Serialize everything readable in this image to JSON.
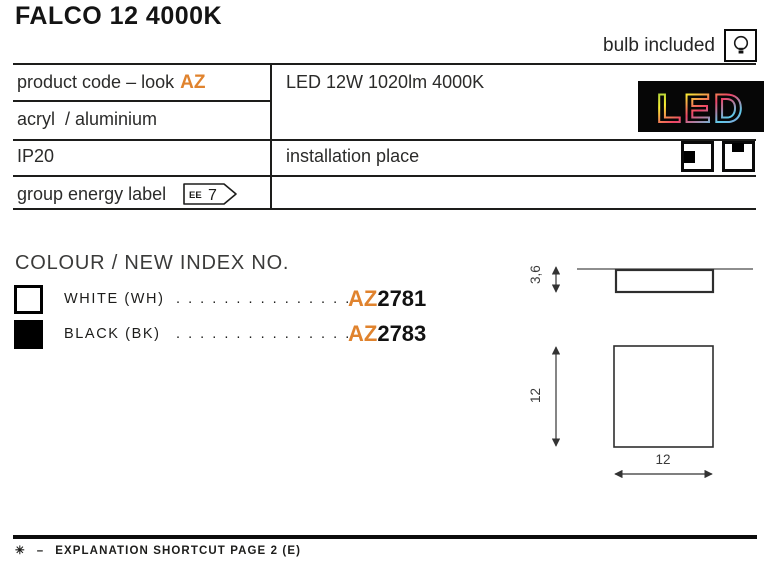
{
  "page": {
    "title": "FALCO 12 4000K",
    "bulb_included": "bulb included"
  },
  "spec_table": {
    "row1_left_label": "product code – look",
    "row1_left_brand": "AZ",
    "row1_right": "LED 12W 1020lm 4000K",
    "row2_left": "acryl  / aluminium",
    "row3_left": "IP20",
    "row3_right": "installation place",
    "row4_left": "group energy label",
    "energy_badge_prefix": "EE",
    "energy_badge_value": "7",
    "led_logo": "LED"
  },
  "colours": {
    "heading": "COLOUR / NEW INDEX NO.",
    "items": [
      {
        "label": "WHITE (WH)",
        "dots": ".  .  .  .  .  .  .  .  .  .  .  .  .  .  .  .",
        "code_prefix": "AZ",
        "code_number": "2781",
        "swatch_hex": "#ffffff"
      },
      {
        "label": "BLACK (BK)",
        "dots": ".  .  .  .  .  .  .  .  .  .  .  .  .  .  .  .",
        "code_prefix": "AZ",
        "code_number": "2783",
        "swatch_hex": "#000000"
      }
    ]
  },
  "dimensions": {
    "profile_height": "3,6",
    "front_height": "12",
    "front_width": "12"
  },
  "footer": {
    "symbol": "✳",
    "dash": "–",
    "label": "EXPLANATION SHORTCUT PAGE 2 (E)"
  },
  "colors": {
    "accent_orange": "#e0832e",
    "text_dark": "#1d1d1b",
    "line_black": "#1d1d1b"
  }
}
